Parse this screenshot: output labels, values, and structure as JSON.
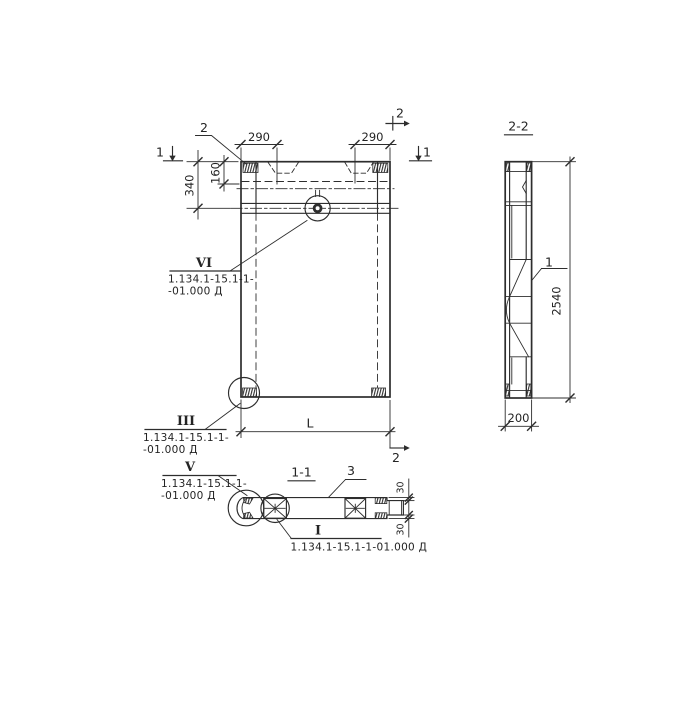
{
  "colors": {
    "ink": "#2d2d2d",
    "paper": "#ffffff"
  },
  "elevation": {
    "detail2_label": "2",
    "dim_290_left": "290",
    "dim_290_right": "290",
    "dim_340": "340",
    "dim_160": "160",
    "dim_length": "L",
    "cut1_left": "1",
    "cut1_right": "1",
    "cut2_top": "2",
    "cut2_bottom": "2"
  },
  "section22": {
    "title": "2-2",
    "part1_label": "1",
    "dim_height": "2540",
    "dim_width": "200"
  },
  "section11": {
    "title": "1-1",
    "part3_label": "3",
    "dim_30_top": "30",
    "dim_30_bottom": "30"
  },
  "callouts": {
    "vi": {
      "label": "VI",
      "line1": "1.134.1-15.1-1-",
      "line2": "-01.000 Д"
    },
    "iii": {
      "label": "III",
      "line1": "1.134.1-15.1-1-",
      "line2": "-01.000 Д"
    },
    "v": {
      "label": "V",
      "line1": "1.134.1-15.1-1-",
      "line2": "-01.000 Д"
    },
    "i": {
      "label": "I",
      "line1": "1.134.1-15.1-1-01.000 Д"
    }
  }
}
